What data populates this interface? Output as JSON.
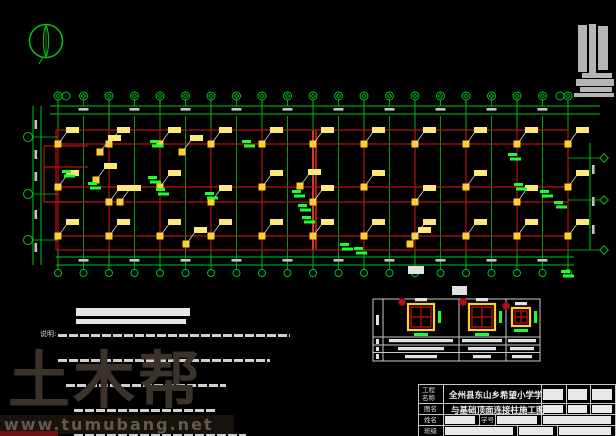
{
  "watermark": {
    "brand": "土木帮",
    "site": "www.tumubang.net"
  },
  "title_block": {
    "project_label": "工程\n名称",
    "project_name": "全州县东山乡希望小学学生宿",
    "drawing_label": "图名",
    "drawing_name": "与基础顶面连接柱施工图",
    "name_label": "姓名",
    "student_id_label": "学号",
    "class_label": "班级"
  },
  "notes": {
    "label": "说明:",
    "bars": [
      [
        18,
        1,
        232
      ],
      [
        18,
        6,
        212
      ],
      [
        26,
        11,
        160
      ],
      [
        34,
        16,
        142
      ],
      [
        34,
        21,
        172
      ],
      [
        40,
        25,
        208
      ]
    ]
  },
  "plan_title_bars": [
    [
      76,
      308,
      114,
      8
    ],
    [
      76,
      319,
      110,
      5
    ]
  ],
  "colors": {
    "green": "#00c41a",
    "bright_green": "#1aff2e",
    "red": "#bb1111",
    "bright_red": "#ff3a22",
    "yellow": "#ffcf2e",
    "pale_yellow": "#ffe87a",
    "dim_text": "#c4c4c4",
    "white": "#e2e2e2",
    "gray_stamp": "#b5b5b5",
    "leader": "#dddddd"
  },
  "plan": {
    "x_start": 58,
    "x_spacing": 25.5,
    "grid_count": 21,
    "highlight_grid_index": 10,
    "top_dim_lines_y": [
      106,
      114
    ],
    "top_bubble_y": 96,
    "extra_top_bubbles_x": [
      66,
      560
    ],
    "outline_top": 130,
    "outline_bottom": 250,
    "rows_y": [
      144,
      187,
      202,
      236
    ],
    "bottom_dim_lines_y": [
      257,
      265
    ],
    "bottom_bubble_y": 273,
    "left_dim_x": [
      33,
      41
    ],
    "left_bubble_x": 28,
    "left_bubbles_y": [
      137,
      194,
      240
    ],
    "left_dim_texts_y": [
      120,
      150,
      172,
      210,
      243
    ],
    "right_dim_x": 590,
    "right_bubble_x": 604,
    "right_bubbles_y": [
      158,
      200,
      250
    ],
    "right_dim_texts_y": [
      165,
      197,
      225
    ],
    "wing": {
      "x": 44,
      "y1": 146,
      "y2": 202,
      "x2": 88,
      "mid_y": 167
    },
    "extra_columns": [
      [
        100,
        152
      ],
      [
        96,
        180
      ],
      [
        120,
        202
      ],
      [
        182,
        152
      ],
      [
        186,
        244
      ],
      [
        410,
        244
      ],
      [
        300,
        186
      ]
    ],
    "annotations_green": [
      [
        150,
        140
      ],
      [
        242,
        140
      ],
      [
        62,
        170
      ],
      [
        88,
        182
      ],
      [
        148,
        176
      ],
      [
        156,
        188
      ],
      [
        205,
        192
      ],
      [
        292,
        190
      ],
      [
        298,
        204
      ],
      [
        302,
        216
      ],
      [
        340,
        243
      ],
      [
        354,
        247
      ],
      [
        508,
        153
      ],
      [
        514,
        183
      ],
      [
        540,
        190
      ],
      [
        554,
        201
      ],
      [
        561,
        270
      ]
    ],
    "white_labels": [
      [
        408,
        266,
        16,
        8
      ],
      [
        452,
        286,
        15,
        9
      ]
    ]
  },
  "stamp_rects": [
    [
      578,
      25,
      9,
      47
    ],
    [
      589,
      24,
      7,
      50
    ],
    [
      598,
      26,
      10,
      44
    ],
    [
      584,
      30,
      3,
      40
    ],
    [
      582,
      73,
      30,
      5
    ],
    [
      576,
      79,
      38,
      7
    ],
    [
      580,
      87,
      32,
      5
    ],
    [
      574,
      93,
      40,
      4
    ]
  ],
  "schedule": {
    "x0": 373,
    "y0": 299,
    "x1": 540,
    "y1": 361,
    "col_x": [
      383,
      459,
      506
    ],
    "row_y": [
      337,
      345,
      352.5
    ],
    "cells": [
      {
        "cx": 421,
        "cy": 317,
        "sq": 26
      },
      {
        "cx": 482,
        "cy": 317,
        "sq": 26
      },
      {
        "cx": 521,
        "cy": 317,
        "sq": 18
      }
    ],
    "text_bars": [
      [
        [
          389,
          339,
          64
        ],
        [
          462,
          339,
          40
        ],
        [
          508,
          339,
          28
        ]
      ],
      [
        [
          398,
          347,
          46
        ],
        [
          468,
          347,
          28
        ],
        [
          510,
          347,
          24
        ]
      ],
      [
        [
          405,
          355,
          32
        ],
        [
          473,
          355,
          18
        ],
        [
          512,
          355,
          20
        ]
      ]
    ],
    "side_marks": [
      [
        376,
        315,
        3,
        10
      ],
      [
        376,
        339,
        3,
        5
      ],
      [
        376,
        347,
        3,
        4
      ],
      [
        376,
        354,
        3,
        5
      ]
    ]
  },
  "compass": {
    "cx": 46,
    "cy": 41,
    "r": 16.5
  }
}
